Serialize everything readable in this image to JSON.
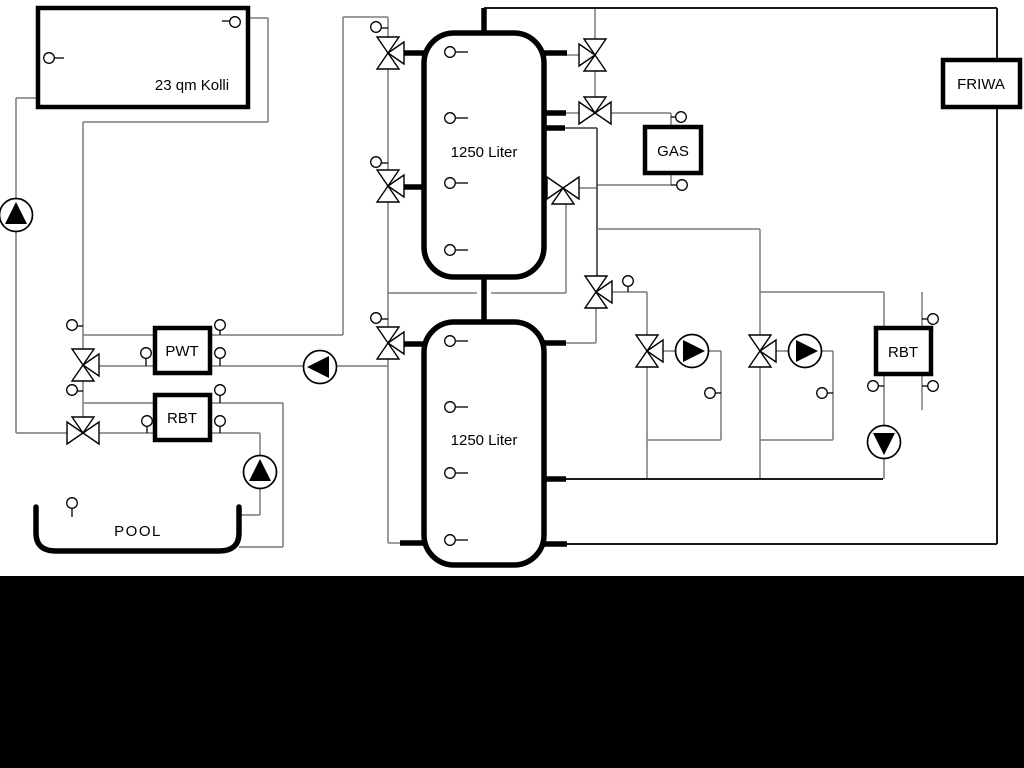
{
  "diagram": {
    "labels": {
      "collector": "23 qm Kolli",
      "tank_top": "1250 Liter",
      "tank_bottom": "1250 Liter",
      "pwt": "PWT",
      "rbt_left": "RBT",
      "rbt_right": "RBT",
      "gas": "GAS",
      "friwa": "FRIWA",
      "pool": "POOL"
    },
    "colors": {
      "background": "#ffffff",
      "thin_lines": "#7a7a7a",
      "main_pipes": "#000000",
      "bottom_band": "#000000"
    }
  }
}
